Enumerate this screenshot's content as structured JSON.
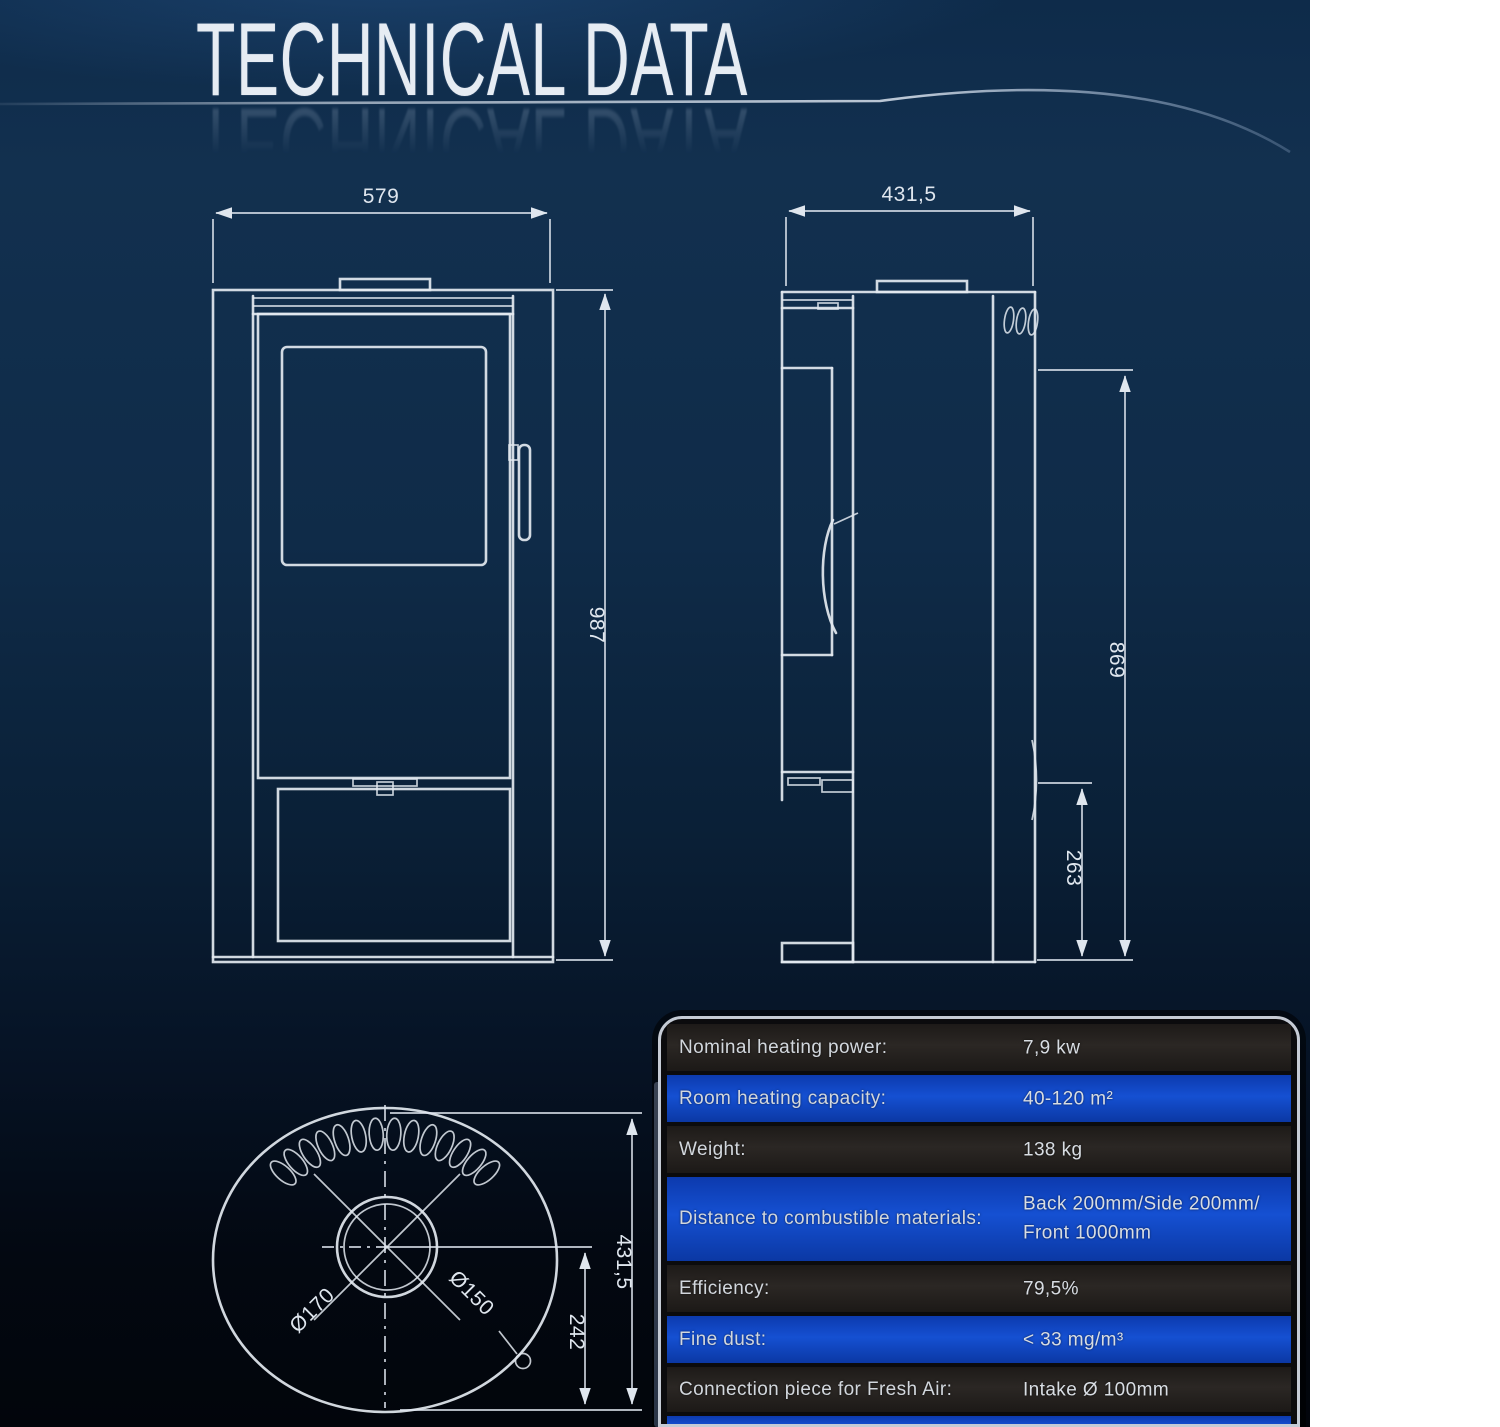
{
  "page": {
    "title": "TECHNICAL DATA"
  },
  "drawings": {
    "front_view": {
      "width_mm": "579",
      "height_mm": "987"
    },
    "side_view": {
      "depth_mm": "431,5",
      "flue_center_height_mm": "869",
      "rear_connection_height_mm": "263"
    },
    "top_view": {
      "depth_mm": "431,5",
      "flue_offset_mm": "242",
      "outer_diameter": "Ø170",
      "inner_diameter": "Ø150"
    }
  },
  "spec_table": {
    "rows": [
      {
        "label": "Nominal heating power:",
        "value": "7,9 kw",
        "value2": ""
      },
      {
        "label": "Room heating capacity:",
        "value": "40-120 m²",
        "value2": ""
      },
      {
        "label": "Weight:",
        "value": "138 kg",
        "value2": ""
      },
      {
        "label": "Distance to combustible materials:",
        "value": "Back 200mm/Side 200mm/",
        "value2": "Front 1000mm"
      },
      {
        "label": "Efficiency:",
        "value": "79,5%",
        "value2": ""
      },
      {
        "label": "Fine dust:",
        "value": "< 33 mg/m³",
        "value2": ""
      },
      {
        "label": "Connection piece for Fresh Air:",
        "value": "Intake Ø 100mm",
        "value2": ""
      }
    ]
  }
}
